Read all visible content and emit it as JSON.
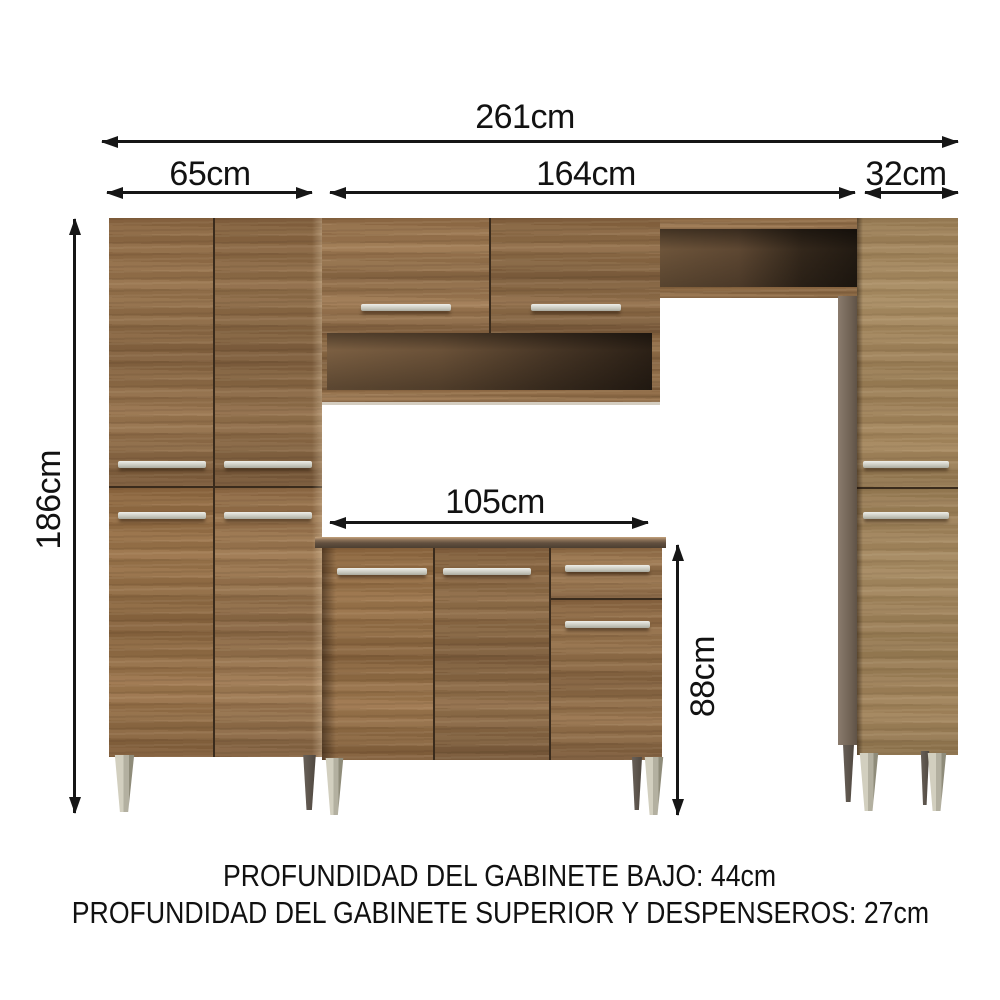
{
  "dimensions": {
    "total_width": "261cm",
    "left_cabinet_width": "65cm",
    "center_section_width": "164cm",
    "right_cabinet_width": "32cm",
    "cabinet_height": "186cm",
    "base_cabinet_width": "105cm",
    "base_cabinet_height": "88cm"
  },
  "notes": {
    "base_depth": "PROFUNDIDAD DEL GABINETE BAJO: 44cm",
    "upper_depth": "PROFUNDIDAD DEL GABINETE SUPERIOR Y DESPENSEROS: 27cm"
  },
  "colors": {
    "wood_main": "#8d6945",
    "wood_light": "#a0835b",
    "interior_dark": "#2b2016",
    "handle_silver": "#d8d8cf",
    "leg_gray": "#b3b0a0",
    "arrow_black": "#161616",
    "background": "#ffffff"
  }
}
